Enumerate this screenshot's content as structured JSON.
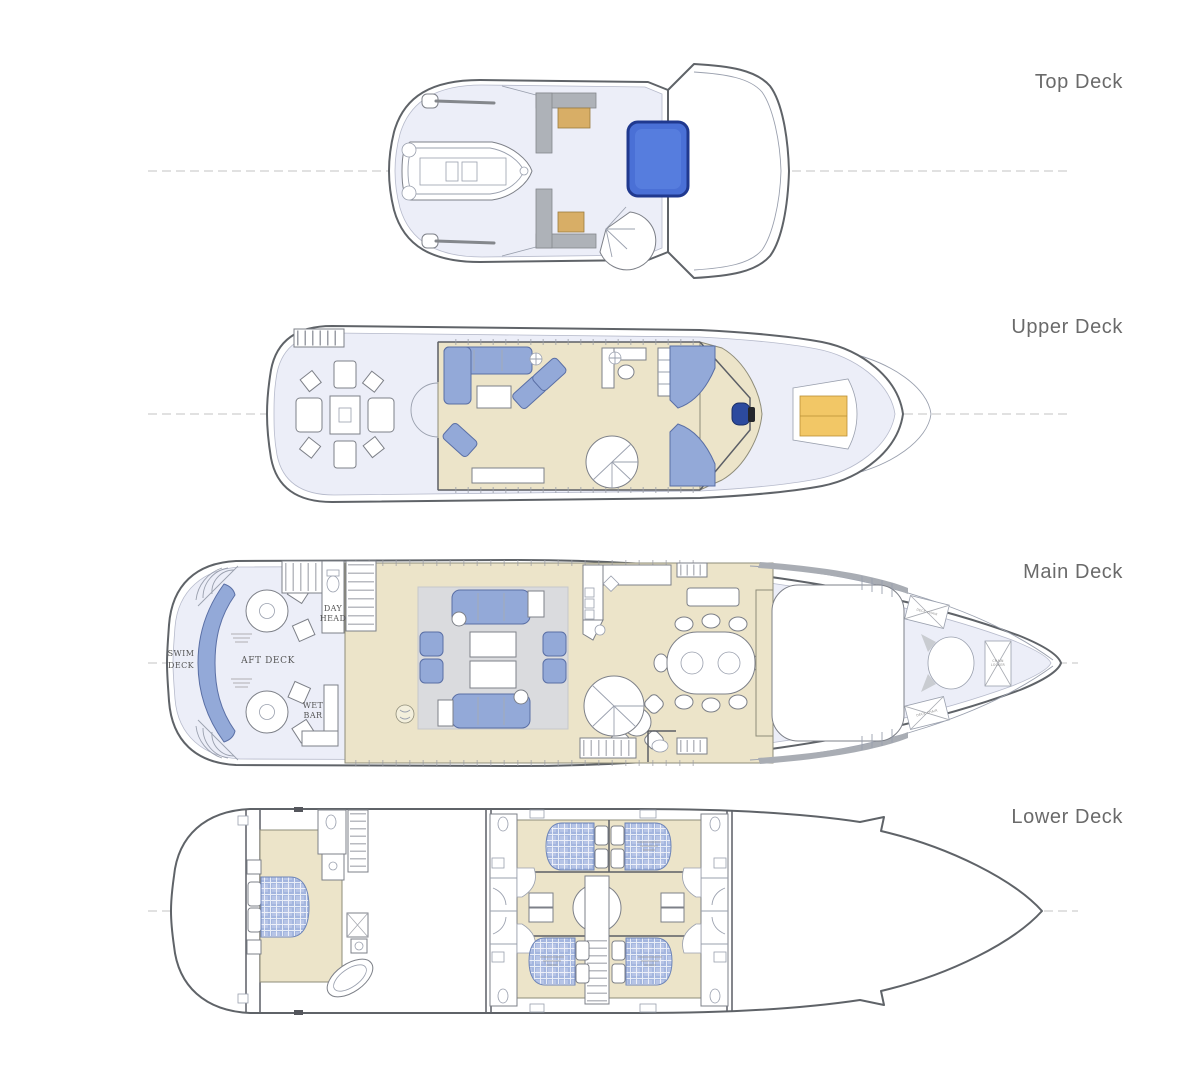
{
  "figure": "yacht-deck-plans",
  "deck_labels": {
    "top": "Top Deck",
    "upper": "Upper Deck",
    "main": "Main Deck",
    "lower": "Lower Deck"
  },
  "plan_labels": {
    "swim_deck": [
      "SWIM",
      "DECK"
    ],
    "aft_deck": "AFT DECK",
    "day_head": [
      "DAY",
      "HEAD"
    ],
    "wet_bar": [
      "WET",
      "BAR"
    ],
    "deck_chair": "DECK CHAIR",
    "chain_locker": [
      "CHAIN",
      "LOCKER"
    ]
  },
  "colors": {
    "hull_outline": "#5f6368",
    "deck_fill": "#eceef8",
    "interior_fill": "#ece4c9",
    "furniture_blue": "#93a9d8",
    "pool_blue": "#4a70d6",
    "sunpad_yellow": "#f2c766",
    "wood_tan": "#d8ae66",
    "label_gray": "#6a6a6a"
  }
}
